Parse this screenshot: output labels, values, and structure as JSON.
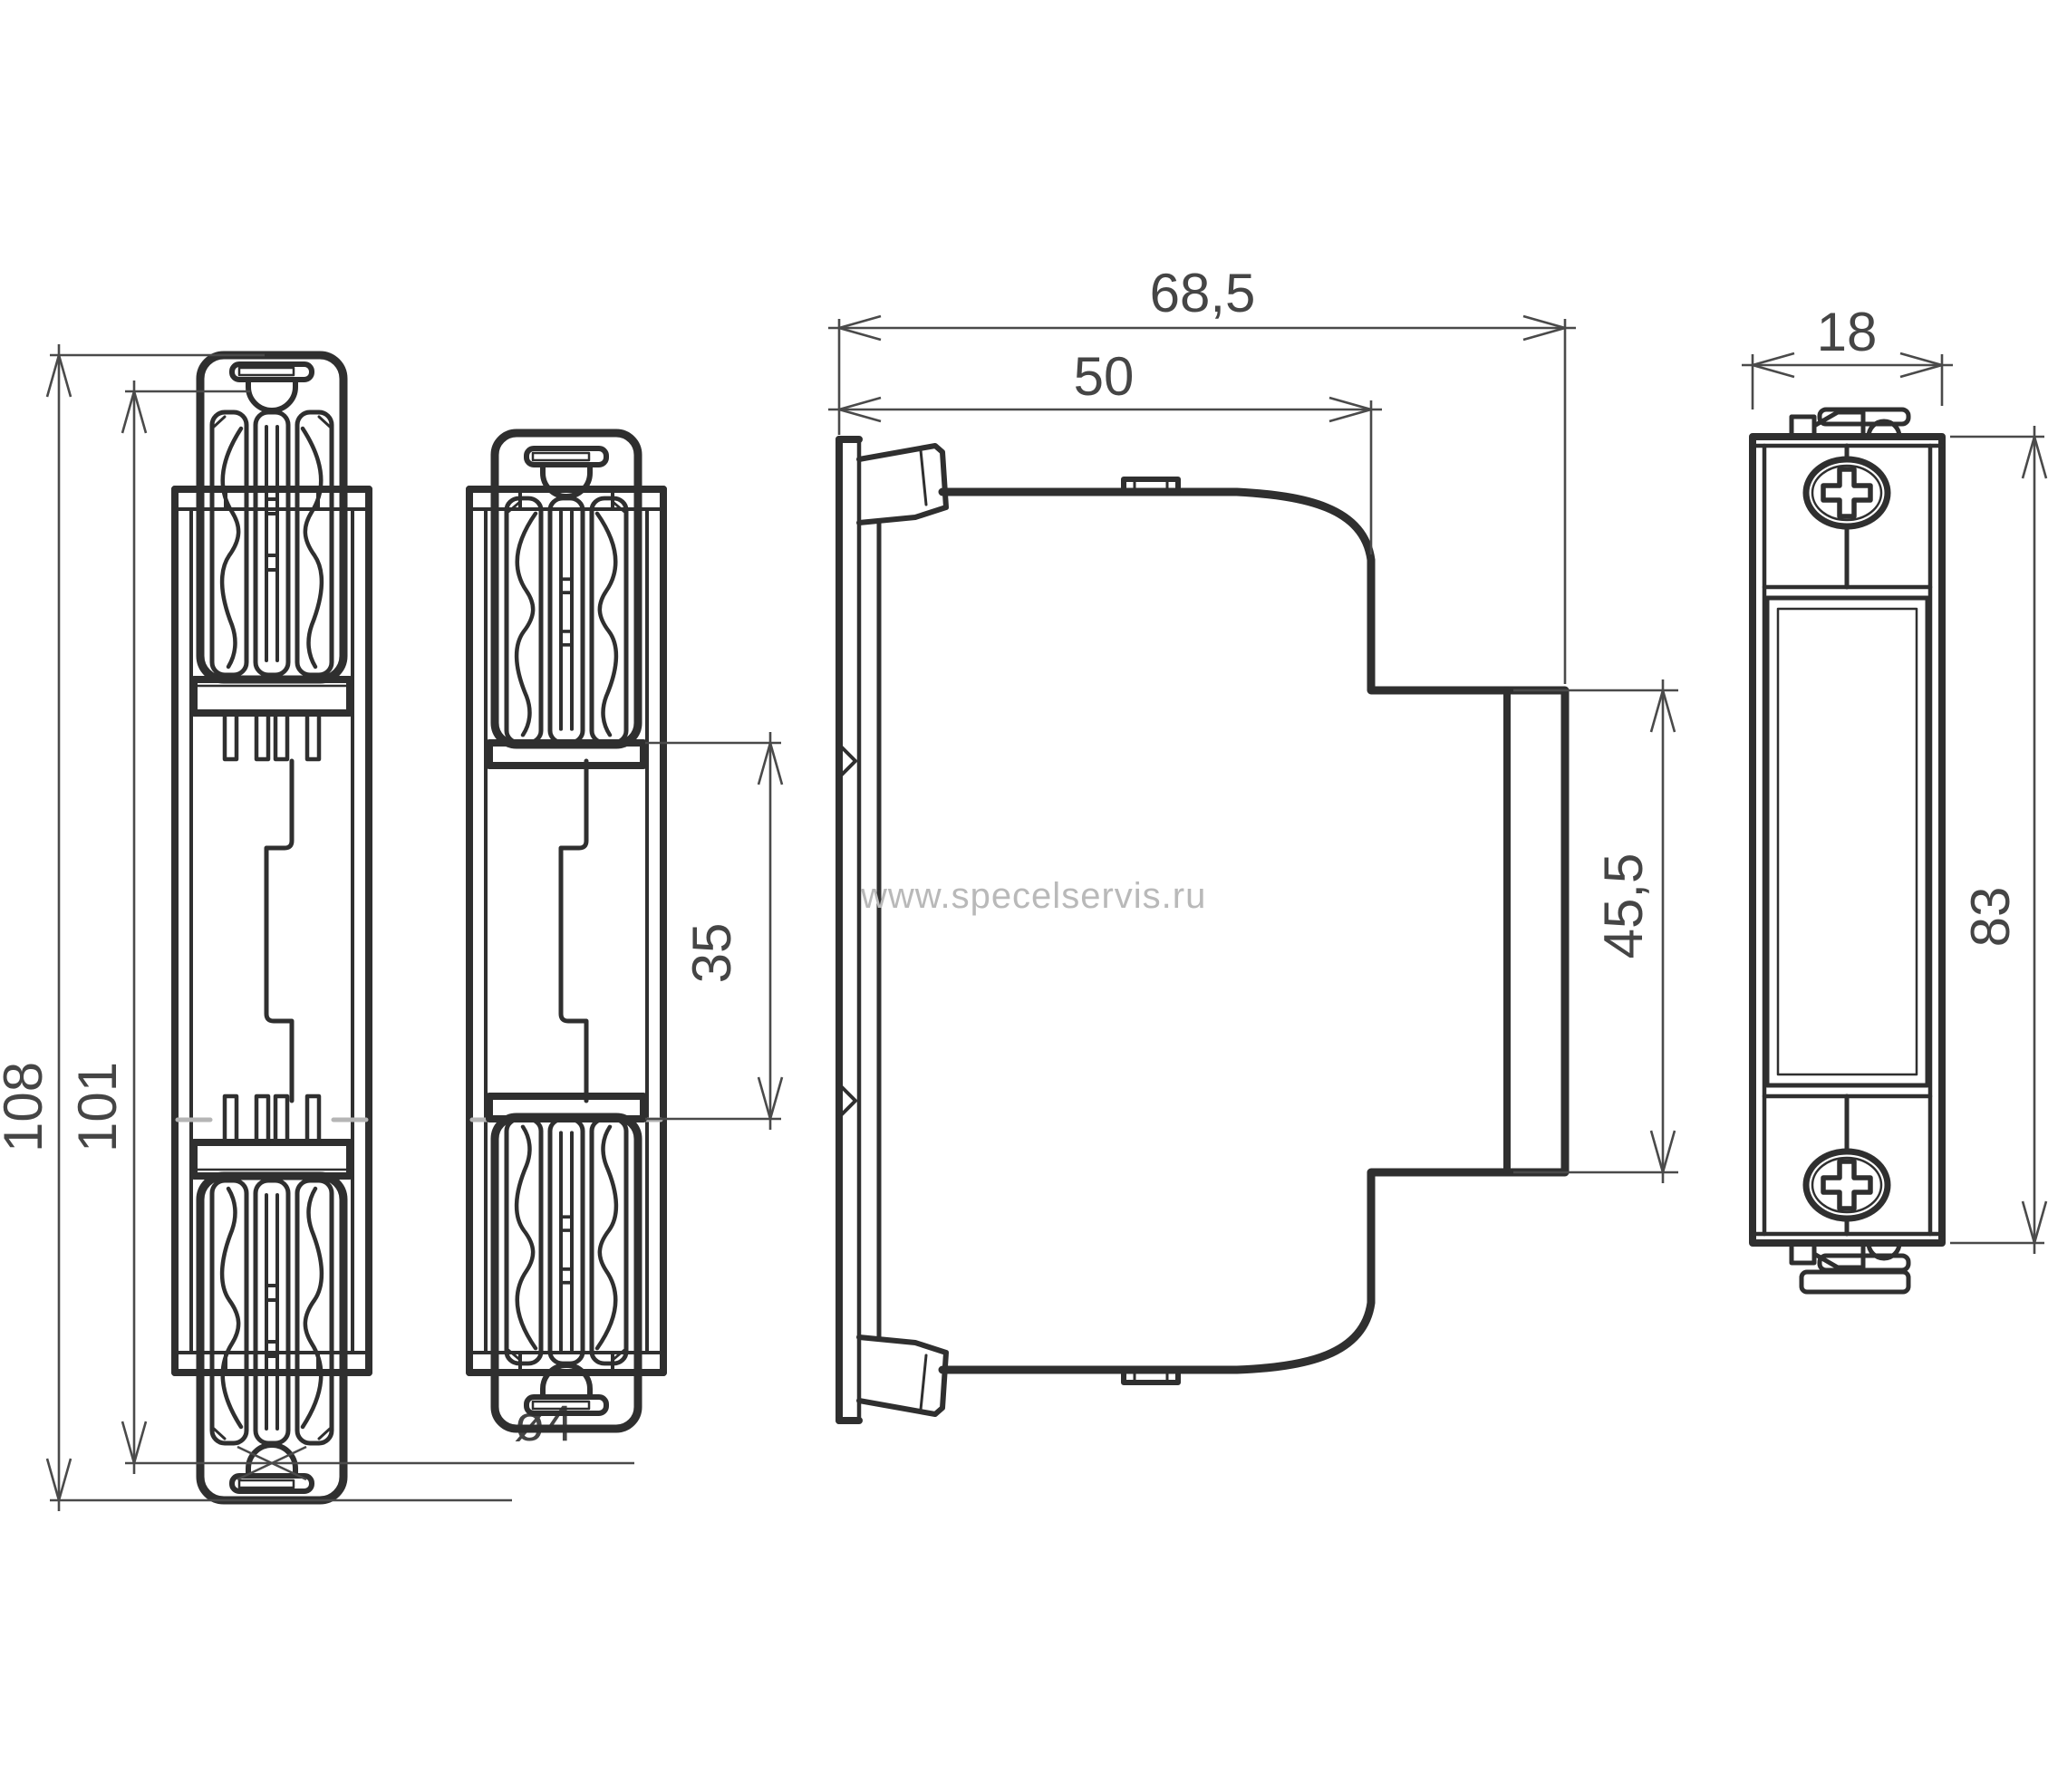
{
  "title": "DIN rail surge protection module - dimensional drawing",
  "watermark": "www.specelservis.ru",
  "colors": {
    "outline": "#2f2f2f",
    "dimension_lines": "#4a4a4a",
    "dimension_text": "#454545",
    "watermark": "#b9b9b9",
    "background": "#ffffff",
    "rail_edge_gray": "#b5b5b5"
  },
  "views": {
    "front_clips_extended": "rear view, mounting clips extended",
    "front_clips_retracted": "rear view, mounting clips retracted",
    "side": "side profile view",
    "face": "front face view with screws and label window"
  },
  "dimensions": {
    "overall_height": "108",
    "hole_spacing": "101",
    "rail_window": "35",
    "hole_diameter": "ø4",
    "depth_overall": "68,5",
    "depth_body": "50",
    "front_height": "45,5",
    "module_width": "18",
    "body_height": "83"
  }
}
